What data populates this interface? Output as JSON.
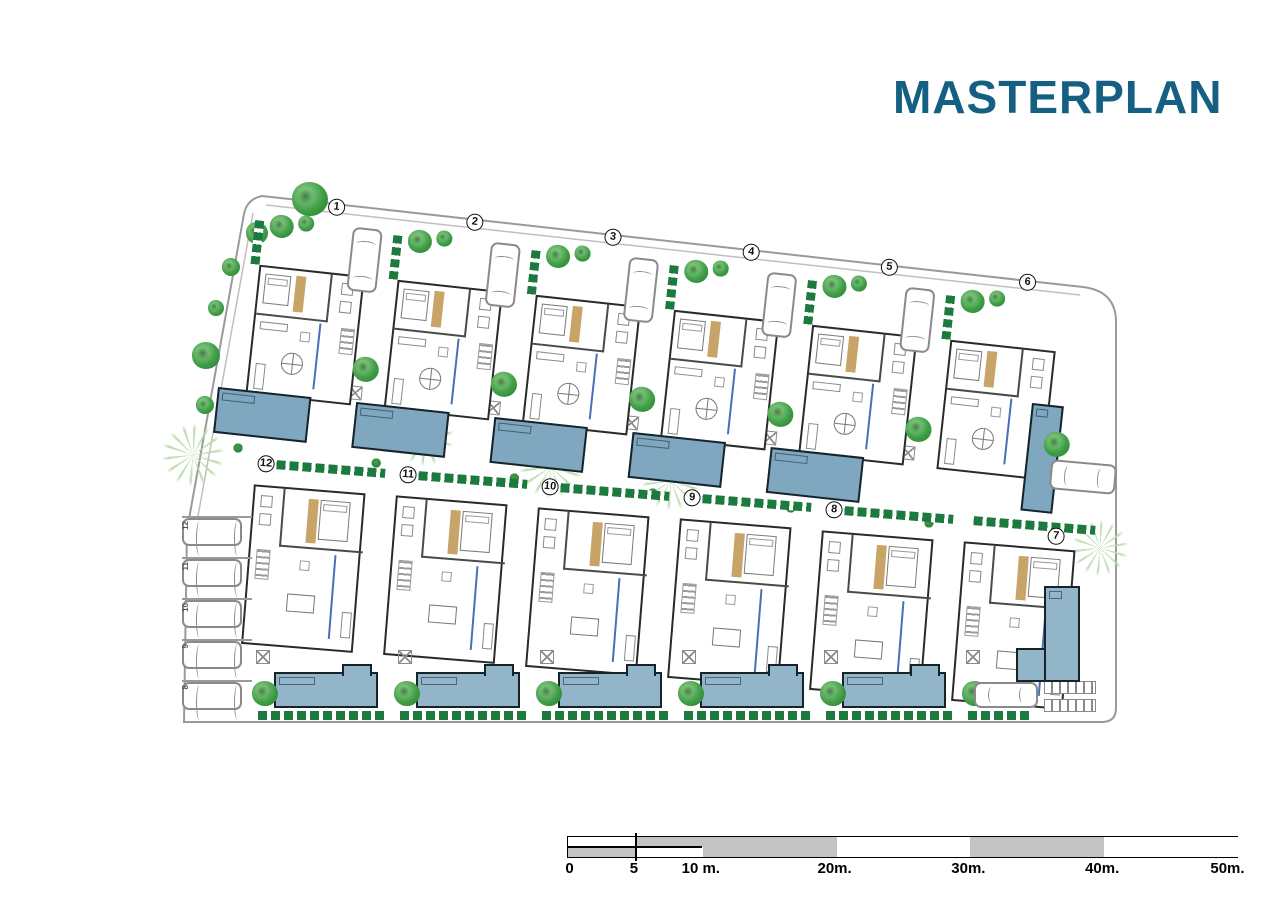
{
  "title": {
    "text": "MASTERPLAN"
  },
  "site": {
    "plots_top": [
      {
        "number": "1",
        "pool": "h"
      },
      {
        "number": "2",
        "pool": "h"
      },
      {
        "number": "3",
        "pool": "h"
      },
      {
        "number": "4",
        "pool": "h"
      },
      {
        "number": "5",
        "pool": "h"
      },
      {
        "number": "6",
        "pool": "v"
      }
    ],
    "plots_bottom": [
      {
        "number": "12",
        "pool": "h"
      },
      {
        "number": "11",
        "pool": "h"
      },
      {
        "number": "10",
        "pool": "h"
      },
      {
        "number": "9",
        "pool": "h"
      },
      {
        "number": "8",
        "pool": "h"
      },
      {
        "number": "7",
        "pool": "corner"
      }
    ],
    "parking_bays": [
      "12",
      "11",
      "10",
      "9",
      "8"
    ]
  },
  "scale_bar": {
    "unit": "m",
    "max_value": 50,
    "ticks": [
      {
        "value": 0,
        "label": "0"
      },
      {
        "value": 5,
        "label": "5"
      },
      {
        "value": 10,
        "label": "10 m."
      },
      {
        "value": 20,
        "label": "20m."
      },
      {
        "value": 30,
        "label": "30m."
      },
      {
        "value": 40,
        "label": "40m."
      },
      {
        "value": 50,
        "label": "50m."
      }
    ],
    "segments": [
      {
        "from": 0,
        "to": 5,
        "style": "split-bottom"
      },
      {
        "from": 5,
        "to": 10,
        "style": "split-top"
      },
      {
        "from": 10,
        "to": 20,
        "style": "gray"
      },
      {
        "from": 20,
        "to": 30,
        "style": "white"
      },
      {
        "from": 30,
        "to": 40,
        "style": "gray"
      },
      {
        "from": 40,
        "to": 50,
        "style": "white"
      }
    ]
  },
  "colors": {
    "title": "#156082",
    "pool": "#7fa8c0",
    "pool2": "#92b5c9",
    "hedge": "#1d7a3e",
    "tree": "#3f9e46",
    "tan": "#c8a468",
    "wall": "#2a2a2a",
    "bound": "#9a9a9a",
    "scale": "#c3c3c3",
    "blue": "#4a6fb5"
  }
}
